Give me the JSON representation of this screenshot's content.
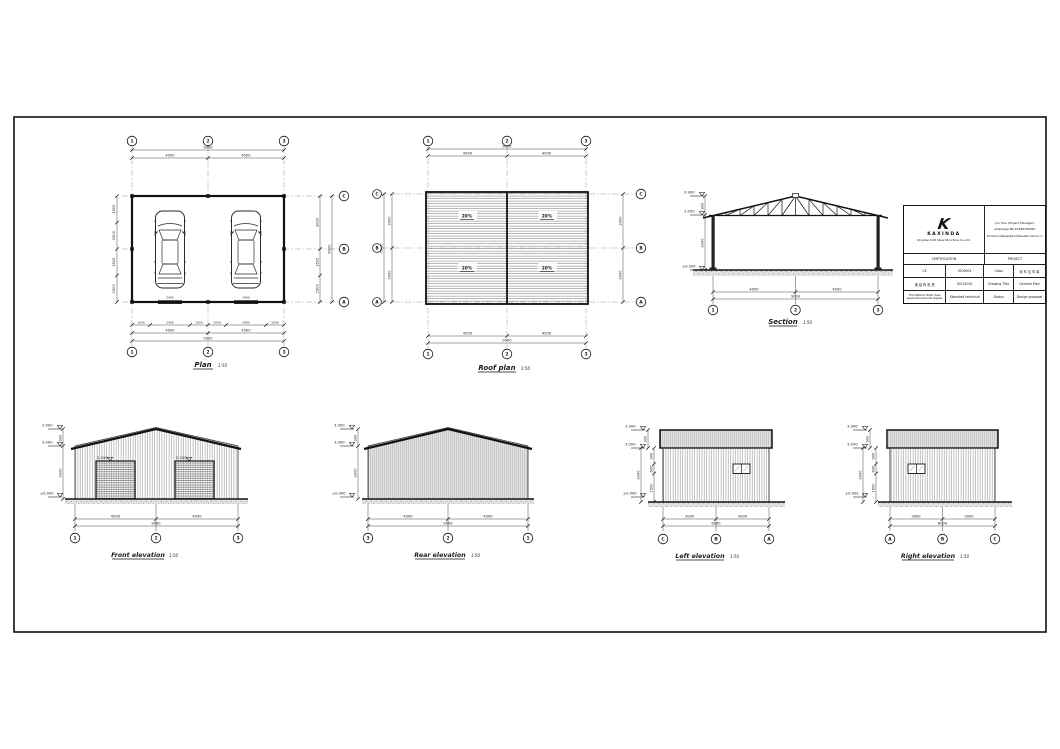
{
  "sheet": {
    "paper_color": "#ffffff",
    "line_color": "#1a1a1a"
  },
  "views": {
    "plan": {
      "title": "Plan",
      "scale": "1:50",
      "grid_cols": [
        "1",
        "2",
        "3"
      ],
      "grid_rows": [
        "C",
        "B",
        "A"
      ],
      "dim_total_top": "9000",
      "dims_top": [
        "4500",
        "4500"
      ],
      "dims_bottom_detail": [
        "1050",
        "2400",
        "1050",
        "1050",
        "2400",
        "1050"
      ],
      "dims_bottom": [
        "4500",
        "4500"
      ],
      "dim_total_bottom": "9000",
      "dims_left": [
        "1500",
        "1500",
        "1500",
        "1500"
      ],
      "dims_right": [
        "3000",
        "1500",
        "1500"
      ],
      "dim_right_total": "6000",
      "door_tags": [
        "2400",
        "2400"
      ]
    },
    "roof_plan": {
      "title": "Roof plan",
      "scale": "1:50",
      "grid_cols": [
        "1",
        "2",
        "3"
      ],
      "grid_rows": [
        "C",
        "B",
        "A"
      ],
      "dim_total_top": "9000",
      "dims_top": [
        "4500",
        "4500"
      ],
      "dims_bottom": [
        "4500",
        "4500"
      ],
      "dim_total_bottom": "9000",
      "dims_left": [
        "3000",
        "3000"
      ],
      "dim_left_total": "6000",
      "dims_right": [
        "3000",
        "3000"
      ],
      "slopes": [
        "20%",
        "20%",
        "20%",
        "20%"
      ]
    },
    "section": {
      "title": "Section",
      "scale": "1:50",
      "levels": [
        "3.900",
        "3.000",
        "±0.000"
      ],
      "vdims": [
        "900",
        "3000"
      ],
      "dims": [
        "4500",
        "4500"
      ],
      "dim_total": "9000",
      "grid": [
        "1",
        "2",
        "3"
      ]
    },
    "front_elevation": {
      "title": "Front elevation",
      "scale": "1:50",
      "levels": [
        "3.900",
        "3.000",
        "±0.000"
      ],
      "vdims": [
        "900",
        "3000"
      ],
      "door_levels": [
        "2.200",
        "2.200"
      ],
      "dims": [
        "4500",
        "4500"
      ],
      "dim_total": "9000",
      "grid": [
        "1",
        "2",
        "3"
      ]
    },
    "rear_elevation": {
      "title": "Rear elevation",
      "scale": "1:50",
      "levels": [
        "3.900",
        "3.000",
        "±0.000"
      ],
      "vdims": [
        "900",
        "3000"
      ],
      "dims": [
        "4500",
        "4500"
      ],
      "dim_total": "9000",
      "grid": [
        "3",
        "2",
        "1"
      ]
    },
    "left_elevation": {
      "title": "Left elevation",
      "scale": "1:50",
      "levels": [
        "3.900",
        "3.000",
        "±0.000"
      ],
      "vdims": [
        "900",
        "3000",
        "900",
        "600",
        "1500"
      ],
      "dims": [
        "3000",
        "3000"
      ],
      "dim_total": "6000",
      "grid": [
        "C",
        "B",
        "A"
      ]
    },
    "right_elevation": {
      "title": "Right elevation",
      "scale": "1:50",
      "levels": [
        "3.900",
        "3.000",
        "±0.000"
      ],
      "vdims": [
        "900",
        "3000",
        "900",
        "600",
        "1500"
      ],
      "dims": [
        "3000",
        "3000"
      ],
      "dim_total": "6000",
      "grid": [
        "A",
        "B",
        "C"
      ]
    }
  },
  "title_block": {
    "logo_char": "K",
    "company": "KAXINDA",
    "company_sub": "Qingdao KXD Steel Structure Co.,Ltd.",
    "contact_line1": "Jon Hao (Project Manager)",
    "contact_line2": "whatsapp:86-15266785867",
    "contact_line3": "Email:kxdsteel@kxdsteelstructure.cn",
    "header_left": "CERTIFICATION",
    "header_right": "PROJECT",
    "row1": [
      "CE",
      "ISO9001",
      "Class",
      "双 车 位 车 库"
    ],
    "row2": [
      "钢 结 构 资 质",
      "ISO14001",
      "Drawing Title",
      "General Plan"
    ],
    "row3_left_line1": "The Material: Metal Class",
    "row3_left_line2": "special structure life register",
    "row3": [
      "Standard technical",
      "Status",
      "Design proposal"
    ]
  }
}
